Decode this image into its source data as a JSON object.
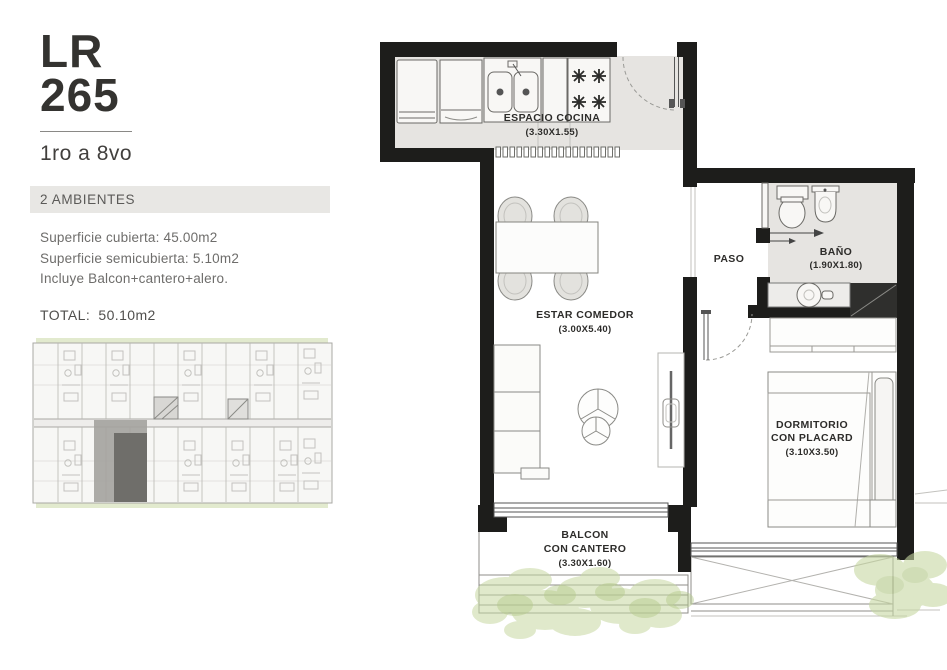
{
  "panel": {
    "code_line1": "LR",
    "code_line2": "265",
    "floors": "1ro a 8vo",
    "badge": "2 AMBIENTES",
    "superficie_cubierta": "Superficie cubierta: 45.00m2",
    "superficie_semicubierta": "Superficie semicubierta: 5.10m2",
    "incluye": "Incluye Balcon+cantero+alero.",
    "total": "TOTAL: 50.10m2"
  },
  "plan": {
    "kitchen": {
      "label": "ESPACIO COCINA",
      "dims": "(3.30X1.55)"
    },
    "paso": {
      "label": "PASO"
    },
    "bath": {
      "label": "BAÑO",
      "dims": "(1.90X1.80)"
    },
    "living": {
      "label": "ESTAR COMEDOR",
      "dims": "(3.00X5.40)"
    },
    "bedroom": {
      "label1": "DORMITORIO",
      "label2": "CON PLACARD",
      "dims": "(3.10X3.50)"
    },
    "balcony": {
      "label1": "BALCON",
      "label2": "CON CANTERO",
      "dims": "(3.30X1.60)"
    }
  },
  "colors": {
    "wall": "#1d1d1b",
    "floor_gray": "#e6e4e1",
    "plant_green": "#c7d8a2",
    "badge_bg": "#e8e7e4"
  }
}
